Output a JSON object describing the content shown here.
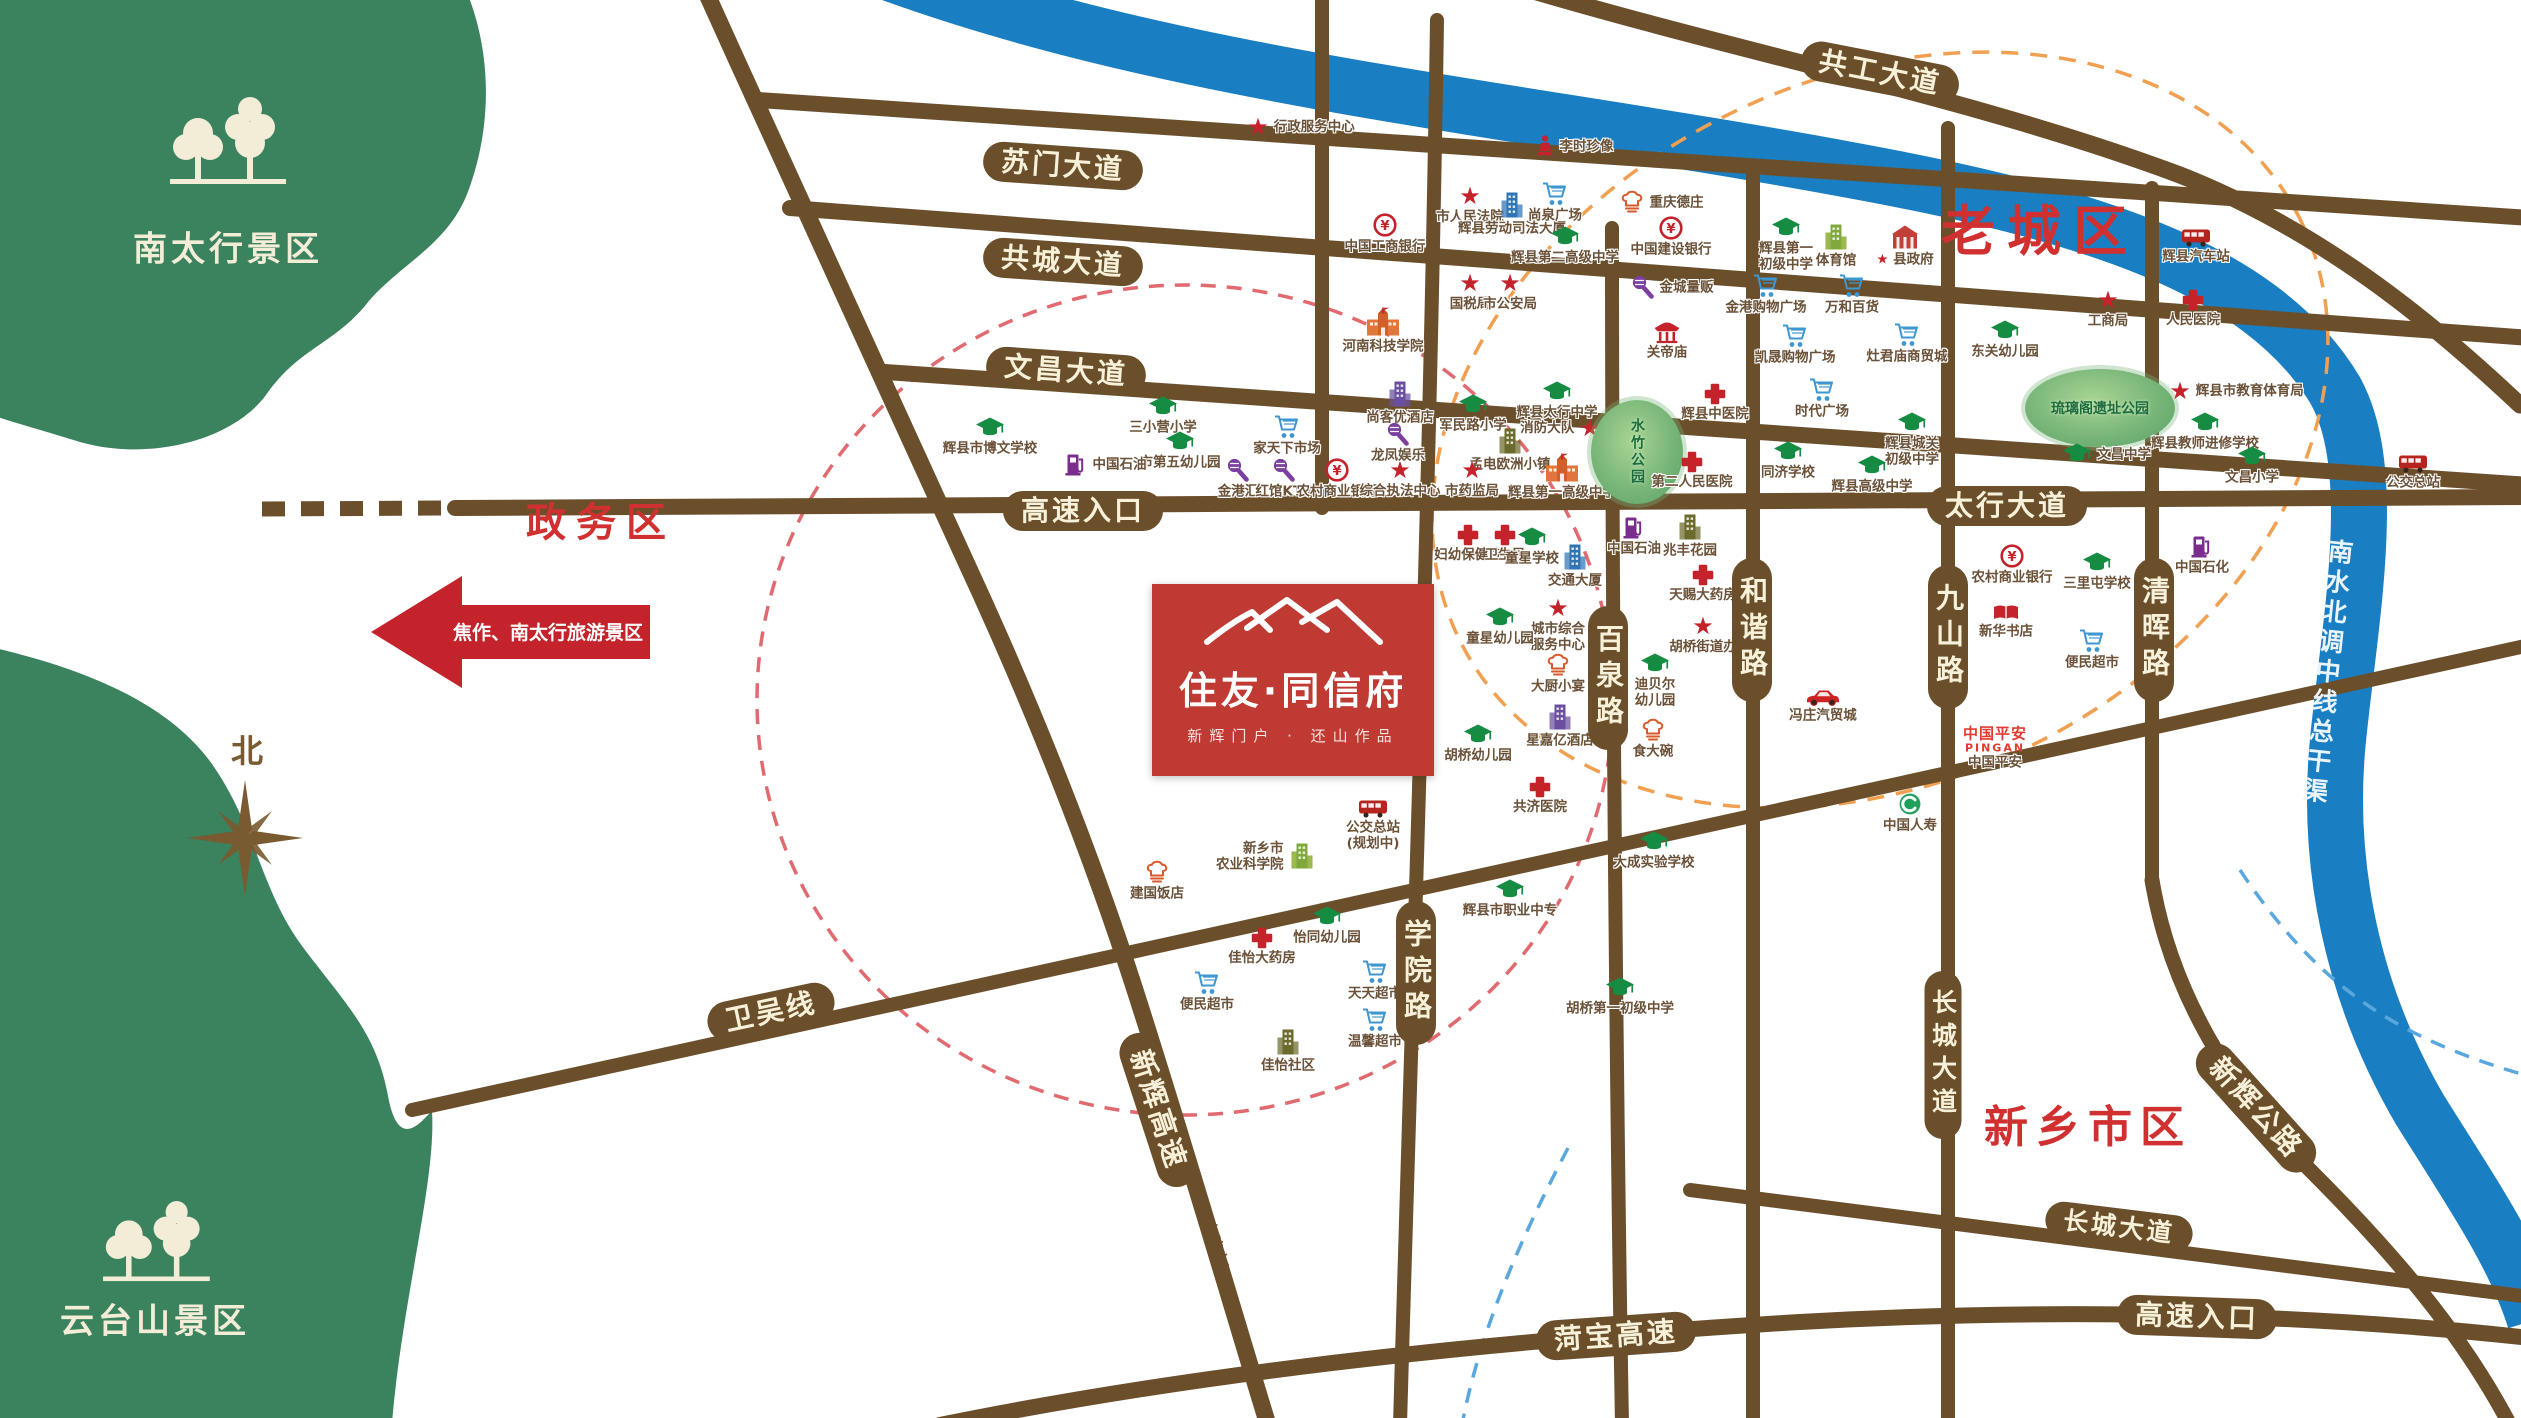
{
  "map": {
    "width": 2521,
    "height": 1418
  },
  "colors": {
    "road": "#6B4F2B",
    "road_text": "#F8F1DA",
    "river": "#1A7EC2",
    "accent_red": "#C5232B",
    "zone_red": "#D03030",
    "logo_red": "#BF3A33",
    "scenic_green": "#2F7A52",
    "ring_pink": "#E06A70",
    "ring_orange": "#F0A050",
    "ring_blue": "#5AA7DD"
  },
  "scenic": [
    {
      "label": "南太行景区",
      "x": 228,
      "y": 246
    },
    {
      "label": "云台山景区",
      "x": 155,
      "y": 1318
    }
  ],
  "river": {
    "name": "南水北调中线总干渠"
  },
  "compass": {
    "label": "北"
  },
  "arrow": {
    "text": "焦作、南太行旅游景区"
  },
  "project": {
    "name": "住友·同信府",
    "tagline": "新辉门户 · 还山作品"
  },
  "zones": [
    {
      "text": "老城区",
      "x": 2040,
      "y": 232,
      "fs": 54,
      "ls": 12
    },
    {
      "text": "政务区",
      "x": 601,
      "y": 523,
      "fs": 40,
      "ls": 10
    },
    {
      "text": "新乡市区",
      "x": 2088,
      "y": 1128,
      "fs": 44,
      "ls": 8
    }
  ],
  "road_labels": [
    {
      "text": "共工大道",
      "x": 1880,
      "y": 73,
      "rot": 11
    },
    {
      "text": "苏门大道",
      "x": 1063,
      "y": 166,
      "rot": 4
    },
    {
      "text": "共城大道",
      "x": 1063,
      "y": 262,
      "rot": 4
    },
    {
      "text": "文昌大道",
      "x": 1066,
      "y": 371,
      "rot": 4
    },
    {
      "text": "高速入口",
      "x": 1083,
      "y": 511,
      "rot": 0
    },
    {
      "text": "太行大道",
      "x": 2007,
      "y": 506,
      "rot": 0
    },
    {
      "text": "百泉路",
      "x": 1608,
      "y": 678,
      "vertical": true
    },
    {
      "text": "和谐路",
      "x": 1752,
      "y": 630,
      "vertical": true
    },
    {
      "text": "九山路",
      "x": 1948,
      "y": 637,
      "vertical": true
    },
    {
      "text": "清晖路",
      "x": 2154,
      "y": 630,
      "vertical": true
    },
    {
      "text": "学院路",
      "x": 1416,
      "y": 973,
      "vertical": true
    },
    {
      "text": "长城大道",
      "x": 1943,
      "y": 1055,
      "vertical": true,
      "fs": 25
    },
    {
      "text": "新辉高速",
      "x": 1158,
      "y": 1110,
      "rot": 72
    },
    {
      "text": "(在建中)",
      "x": 1215,
      "y": 1243,
      "rot": 72,
      "plain": true,
      "fs": 14
    },
    {
      "text": "新辉公路",
      "x": 2256,
      "y": 1108,
      "rot": 48
    },
    {
      "text": "卫吴线",
      "x": 771,
      "y": 1012,
      "rot": -12
    },
    {
      "text": "长城大道",
      "x": 2119,
      "y": 1227,
      "rot": 7,
      "fs": 25
    },
    {
      "text": "菏宝高速",
      "x": 1616,
      "y": 1336,
      "rot": -4
    },
    {
      "text": "高速入口",
      "x": 2197,
      "y": 1317,
      "rot": 2
    }
  ],
  "pois": [
    {
      "n": "行政服务中心",
      "t": "star",
      "x": 1258,
      "y": 127,
      "side": "right"
    },
    {
      "n": "李时珍像",
      "t": "statue",
      "x": 1545,
      "y": 146,
      "side": "right"
    },
    {
      "n": "市人民法院",
      "t": "star",
      "x": 1470,
      "y": 196
    },
    {
      "n": "辉县劳动司法大厦",
      "t": "build_blue",
      "x": 1512,
      "y": 205
    },
    {
      "n": "尚泉广场",
      "t": "shop",
      "x": 1555,
      "y": 194
    },
    {
      "n": "辉县第二高级中学",
      "t": "school",
      "x": 1565,
      "y": 237
    },
    {
      "n": "重庆德庄",
      "t": "food",
      "x": 1632,
      "y": 202,
      "side": "right"
    },
    {
      "n": "中国建设银行",
      "t": "bank",
      "x": 1671,
      "y": 228
    },
    {
      "n": "辉县第一初级中学",
      "t": "school",
      "x": 1786,
      "y": 228,
      "lines": [
        "辉县第一",
        "初级中学"
      ]
    },
    {
      "n": "中国工商银行",
      "t": "bank",
      "x": 1385,
      "y": 225
    },
    {
      "n": "国税局",
      "t": "star",
      "x": 1470,
      "y": 283
    },
    {
      "n": "市公安局",
      "t": "star",
      "x": 1510,
      "y": 283
    },
    {
      "n": "河南科技学院",
      "t": "school_bldg",
      "x": 1383,
      "y": 322
    },
    {
      "n": "金城量贩",
      "t": "ktv",
      "x": 1643,
      "y": 287,
      "side": "right"
    },
    {
      "n": "关帝庙",
      "t": "temple",
      "x": 1667,
      "y": 332
    },
    {
      "n": "金港购物广场",
      "t": "shop",
      "x": 1766,
      "y": 286
    },
    {
      "n": "万和百货",
      "t": "shop",
      "x": 1852,
      "y": 286
    },
    {
      "n": "灶君庙商贸城",
      "t": "shop",
      "x": 1907,
      "y": 335
    },
    {
      "n": "凯晟购物广场",
      "t": "shop",
      "x": 1795,
      "y": 336
    },
    {
      "n": "时代广场",
      "t": "shop",
      "x": 1822,
      "y": 390
    },
    {
      "n": "辉县城关初级中学",
      "t": "school",
      "x": 1912,
      "y": 423,
      "lines": [
        "辉县城关",
        "初级中学"
      ]
    },
    {
      "n": "辉县高级中学",
      "t": "school",
      "x": 1872,
      "y": 466
    },
    {
      "n": "东关幼儿园",
      "t": "school",
      "x": 2005,
      "y": 331
    },
    {
      "n": "工商局",
      "t": "star",
      "x": 2108,
      "y": 300
    },
    {
      "n": "人民医院",
      "t": "hospital",
      "x": 2193,
      "y": 300
    },
    {
      "n": "琉璃阁遗址公园",
      "t": "park",
      "x": 2100,
      "y": 408,
      "w": 150,
      "h": 78
    },
    {
      "n": "文昌中学",
      "t": "school",
      "x": 2077,
      "y": 454,
      "side": "right"
    },
    {
      "n": "辉县市教育体育局",
      "t": "star",
      "x": 2180,
      "y": 391,
      "side": "right"
    },
    {
      "n": "辉县教师进修学校",
      "t": "school",
      "x": 2205,
      "y": 423
    },
    {
      "n": "文昌小学",
      "t": "school",
      "x": 2252,
      "y": 457
    },
    {
      "n": "辉县汽车站",
      "t": "bus",
      "x": 2196,
      "y": 237
    },
    {
      "n": "体育馆",
      "t": "build_green",
      "x": 1836,
      "y": 237
    },
    {
      "n": "县政府",
      "t": "gov",
      "x": 1905,
      "y": 237,
      "star": true
    },
    {
      "n": "辉县市博文学校",
      "t": "school",
      "x": 990,
      "y": 428
    },
    {
      "n": "三小营小学",
      "t": "school",
      "x": 1163,
      "y": 407
    },
    {
      "n": "市第五幼儿园",
      "t": "school",
      "x": 1180,
      "y": 442
    },
    {
      "n": "家天下市场",
      "t": "shop",
      "x": 1287,
      "y": 427
    },
    {
      "n": "中国石油",
      "t": "gas",
      "x": 1076,
      "y": 464,
      "side": "right"
    },
    {
      "n": "金港汇",
      "t": "ktv",
      "x": 1238,
      "y": 470
    },
    {
      "n": "红馆KTV",
      "t": "ktv",
      "x": 1284,
      "y": 470
    },
    {
      "n": "农村商业银行",
      "t": "bank",
      "x": 1337,
      "y": 470
    },
    {
      "n": "综合执法中心",
      "t": "star",
      "x": 1400,
      "y": 470
    },
    {
      "n": "尚客优酒店",
      "t": "build_purple",
      "x": 1400,
      "y": 394
    },
    {
      "n": "龙凤娱乐",
      "t": "ktv",
      "x": 1398,
      "y": 434
    },
    {
      "n": "军民路小学",
      "t": "school",
      "x": 1473,
      "y": 405
    },
    {
      "n": "辉县太行中学",
      "t": "school",
      "x": 1557,
      "y": 392
    },
    {
      "n": "消防大队",
      "t": "star",
      "x": 1590,
      "y": 428,
      "side": "left"
    },
    {
      "n": "孟电欧洲小镇",
      "t": "build_olive",
      "x": 1510,
      "y": 441
    },
    {
      "n": "市药监局",
      "t": "star",
      "x": 1472,
      "y": 470
    },
    {
      "n": "辉县第一高级中学",
      "t": "school_bldg",
      "x": 1562,
      "y": 468
    },
    {
      "n": "水竹公园",
      "t": "park",
      "x": 1637,
      "y": 452,
      "w": 92,
      "h": 104,
      "vert": true
    },
    {
      "n": "辉县中医院",
      "t": "hospital",
      "x": 1715,
      "y": 394
    },
    {
      "n": "第二人民医院",
      "t": "hospital",
      "x": 1692,
      "y": 462
    },
    {
      "n": "同济学校",
      "t": "school",
      "x": 1788,
      "y": 452
    },
    {
      "n": "妇幼保健院",
      "t": "hospital",
      "x": 1468,
      "y": 535
    },
    {
      "n": "卫生局",
      "t": "hospital",
      "x": 1505,
      "y": 535
    },
    {
      "n": "童星学校",
      "t": "school",
      "x": 1532,
      "y": 538
    },
    {
      "n": "交通大厦",
      "t": "build_blue",
      "x": 1575,
      "y": 557
    },
    {
      "n": "中国石油",
      "t": "gas",
      "x": 1634,
      "y": 527
    },
    {
      "n": "兆丰花园",
      "t": "build_olive",
      "x": 1690,
      "y": 527
    },
    {
      "n": "天赐大药房",
      "t": "hospital",
      "x": 1703,
      "y": 575
    },
    {
      "n": "胡桥街道办",
      "t": "star",
      "x": 1703,
      "y": 626
    },
    {
      "n": "迪贝尔幼儿园",
      "t": "school",
      "x": 1655,
      "y": 664,
      "lines": [
        "迪贝尔",
        "幼儿园"
      ]
    },
    {
      "n": "食大碗",
      "t": "food",
      "x": 1653,
      "y": 730
    },
    {
      "n": "城市综合服务中心",
      "t": "star",
      "x": 1558,
      "y": 608,
      "lines": [
        "城市综合",
        "服务中心"
      ]
    },
    {
      "n": "大厨小宴",
      "t": "food",
      "x": 1558,
      "y": 665
    },
    {
      "n": "星嘉亿酒店",
      "t": "build_purple",
      "x": 1560,
      "y": 717
    },
    {
      "n": "童星幼儿园",
      "t": "school",
      "x": 1500,
      "y": 618
    },
    {
      "n": "胡桥幼儿园",
      "t": "school",
      "x": 1478,
      "y": 735
    },
    {
      "n": "共济医院",
      "t": "hospital",
      "x": 1540,
      "y": 787
    },
    {
      "n": "大成实验学校",
      "t": "school",
      "x": 1654,
      "y": 842
    },
    {
      "n": "冯庄汽贸城",
      "t": "car",
      "x": 1823,
      "y": 697
    },
    {
      "n": "中国平安",
      "t": "pingan",
      "x": 1995,
      "y": 740
    },
    {
      "n": "中国人寿",
      "t": "life",
      "x": 1910,
      "y": 804
    },
    {
      "n": "公交总站",
      "t": "bus",
      "x": 1373,
      "y": 808,
      "lines": [
        "公交总站",
        "(规划中)"
      ]
    },
    {
      "n": "新乡市农业科学院",
      "t": "build_green",
      "x": 1302,
      "y": 856,
      "side": "left",
      "lines": [
        "新乡市",
        "农业科学院"
      ]
    },
    {
      "n": "建国饭店",
      "t": "food",
      "x": 1157,
      "y": 872
    },
    {
      "n": "佳怡大药房",
      "t": "hospital",
      "x": 1262,
      "y": 938
    },
    {
      "n": "怡同幼儿园",
      "t": "school",
      "x": 1327,
      "y": 917
    },
    {
      "n": "便民超市",
      "t": "shop",
      "x": 1207,
      "y": 983
    },
    {
      "n": "天天超市",
      "t": "shop",
      "x": 1375,
      "y": 972
    },
    {
      "n": "温馨超市",
      "t": "shop",
      "x": 1375,
      "y": 1020
    },
    {
      "n": "佳怡社区",
      "t": "build_olive",
      "x": 1288,
      "y": 1042
    },
    {
      "n": "辉县市职业中专",
      "t": "school",
      "x": 1510,
      "y": 890
    },
    {
      "n": "胡桥第一初级中学",
      "t": "school",
      "x": 1620,
      "y": 988
    },
    {
      "n": "农村商业银行",
      "t": "bank",
      "x": 2012,
      "y": 556
    },
    {
      "n": "三里屯学校",
      "t": "school",
      "x": 2097,
      "y": 563
    },
    {
      "n": "中国石化",
      "t": "gas",
      "x": 2202,
      "y": 546
    },
    {
      "n": "新华书店",
      "t": "book",
      "x": 2006,
      "y": 613
    },
    {
      "n": "便民超市",
      "t": "shop",
      "x": 2092,
      "y": 641
    },
    {
      "n": "公交总站",
      "t": "bus",
      "x": 2413,
      "y": 463
    }
  ]
}
